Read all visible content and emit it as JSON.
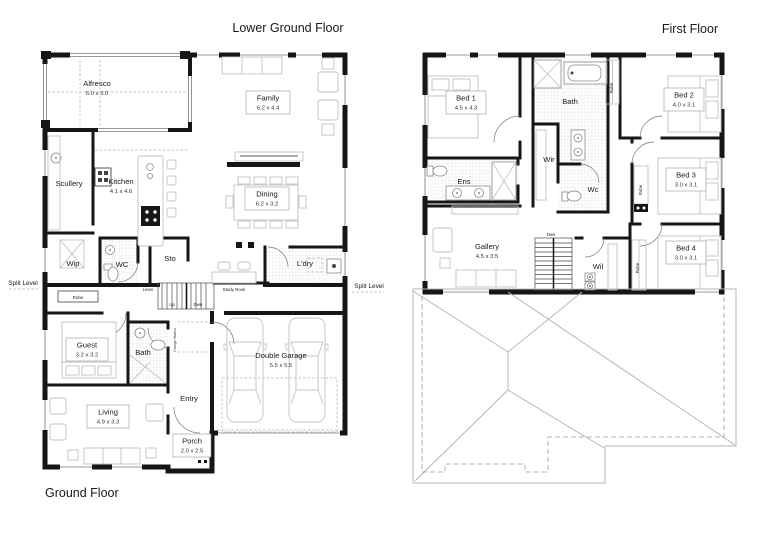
{
  "titles": {
    "lower_ground": "Lower Ground Floor",
    "ground": "Ground Floor",
    "first": "First Floor"
  },
  "annotations": {
    "split_level": "Split Level",
    "robe": "Robe",
    "linen": "Linen",
    "up": "Up",
    "dwn": "Dwn",
    "study_nook": "Study Nook",
    "charge_station": "Charge Station"
  },
  "gf": {
    "alfresco": {
      "name": "Alfresco",
      "dims": "6.0 x 3.0"
    },
    "family": {
      "name": "Family",
      "dims": "6.2 x 4.4"
    },
    "scullery": {
      "name": "Scullery"
    },
    "kitchen": {
      "name": "Kitchen",
      "dims": "4.1 x 4.6"
    },
    "dining": {
      "name": "Dining",
      "dims": "6.2 x 3.2"
    },
    "wip": {
      "name": "Wip"
    },
    "wc": {
      "name": "WC"
    },
    "sto": {
      "name": "Sto"
    },
    "ldry": {
      "name": "L'dry"
    },
    "guest": {
      "name": "Guest",
      "dims": "3.2 x 3.2"
    },
    "bath": {
      "name": "Bath"
    },
    "entry": {
      "name": "Entry"
    },
    "garage": {
      "name": "Double Garage",
      "dims": "5.5 x 5.5"
    },
    "living": {
      "name": "Living",
      "dims": "4.9 x 3.3"
    },
    "porch": {
      "name": "Porch",
      "dims": "2.0 x 2.5"
    }
  },
  "ff": {
    "bed1": {
      "name": "Bed 1",
      "dims": "4.5 x 4.3"
    },
    "bath": {
      "name": "Bath"
    },
    "bed2": {
      "name": "Bed 2",
      "dims": "4.0 x 3.1"
    },
    "wir": {
      "name": "Wir"
    },
    "ens": {
      "name": "Ens"
    },
    "wc": {
      "name": "Wc"
    },
    "bed3": {
      "name": "Bed 3",
      "dims": "3.0 x 3.1"
    },
    "gallery": {
      "name": "Gallery",
      "dims": "4.5 x 3.5"
    },
    "wil": {
      "name": "Wil"
    },
    "bed4": {
      "name": "Bed 4",
      "dims": "3.0 x 3.1"
    }
  },
  "colors": {
    "wall": "#161616",
    "furniture": "#c2c2c2",
    "wet_area_hatch": "#dcdcdc",
    "roof_line": "#b7b7b7",
    "text": "#1a1a1a",
    "background": "#ffffff"
  }
}
